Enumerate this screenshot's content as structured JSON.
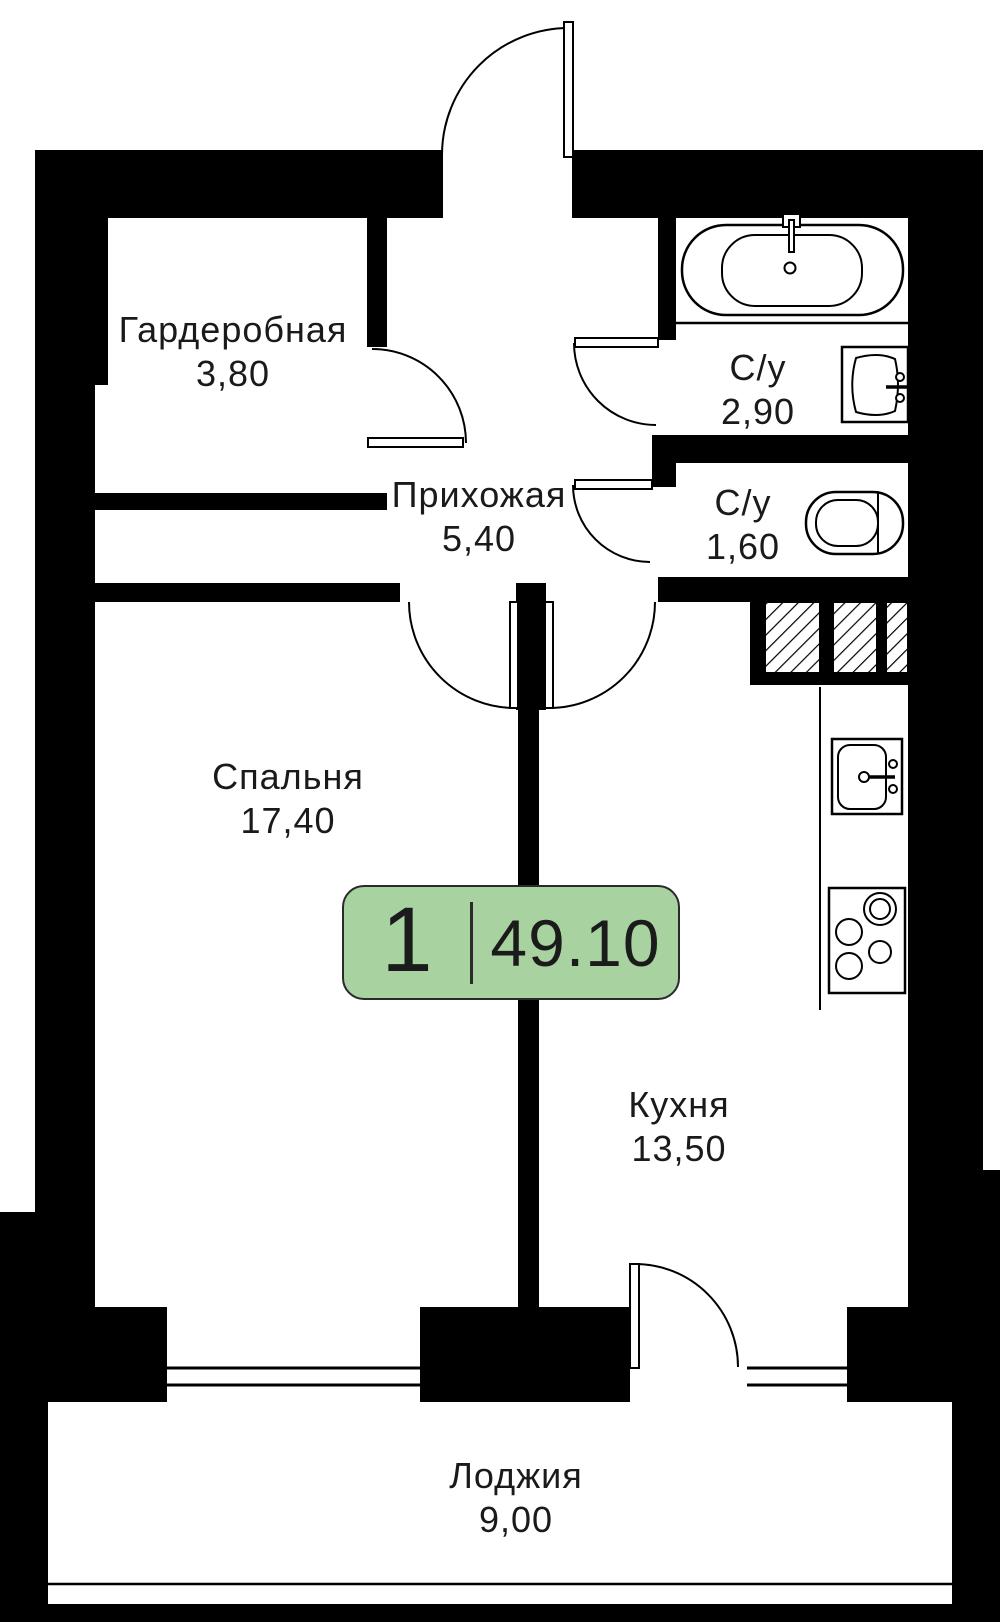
{
  "plan": {
    "badge": {
      "rooms_count": "1",
      "total_area": "49.10"
    },
    "rooms": [
      {
        "id": "wardrobe",
        "name": "Гардеробная",
        "area": "3,80"
      },
      {
        "id": "hallway",
        "name": "Прихожая",
        "area": "5,40"
      },
      {
        "id": "bathroom-1",
        "name": "С/у",
        "area": "2,90"
      },
      {
        "id": "bathroom-2",
        "name": "С/у",
        "area": "1,60"
      },
      {
        "id": "bedroom",
        "name": "Спальня",
        "area": "17,40"
      },
      {
        "id": "kitchen",
        "name": "Кухня",
        "area": "13,50"
      },
      {
        "id": "loggia",
        "name": "Лоджия",
        "area": "9,00"
      }
    ],
    "fixtures": [
      "bathtub-icon",
      "washbasin-icon",
      "toilet-icon",
      "kitchen-sink-icon",
      "stove-icon",
      "vent-shaft-icon"
    ],
    "colors": {
      "walls": "#000000",
      "badge_fill": "#a8d3a1",
      "badge_border": "#2a2a2a",
      "text": "#1a1a1a",
      "background": "#ffffff"
    }
  }
}
